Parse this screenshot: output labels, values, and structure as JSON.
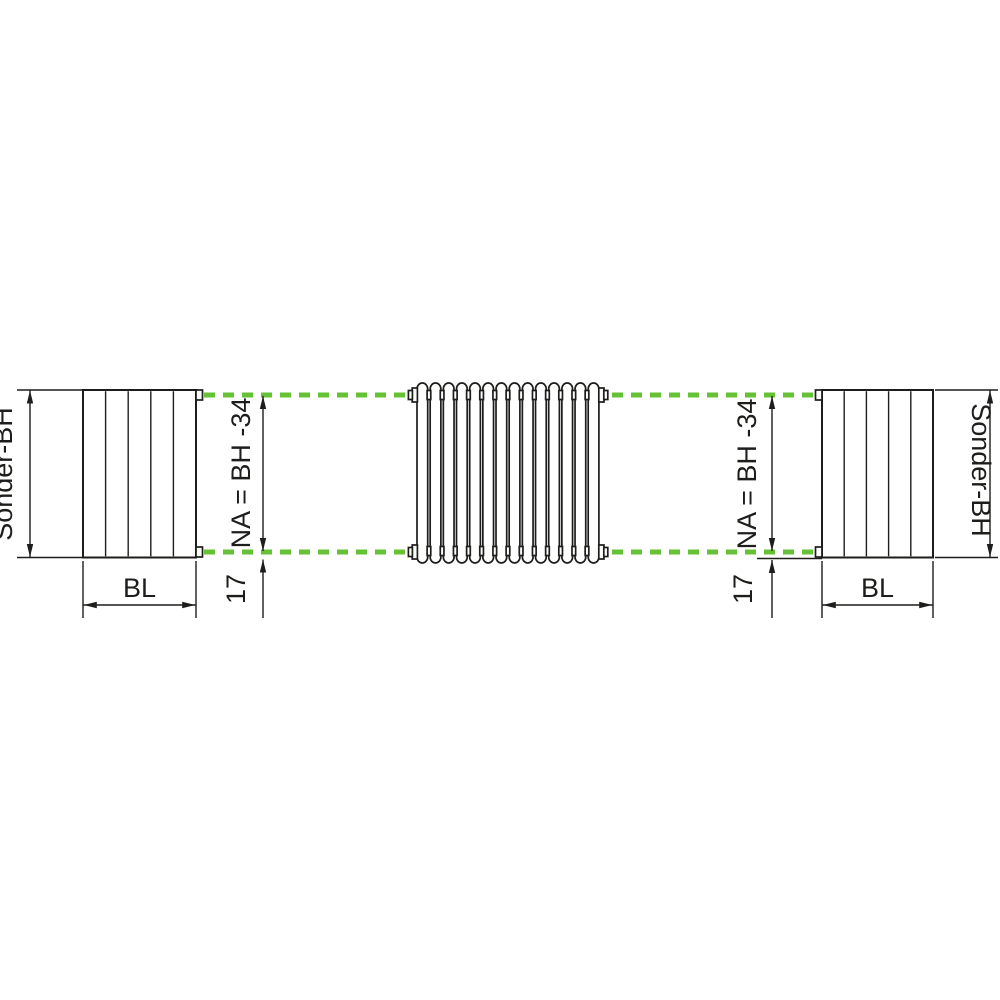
{
  "title": "Radiator nipple connection dimension drawing",
  "colors": {
    "accent_green": "#65c235",
    "line": "#1d1d1b"
  },
  "radiator": {
    "tube_count": 14
  },
  "side_panels": {
    "section_count": 5
  },
  "labels": {
    "height_left": "Sonder-BH",
    "height_right": "Sonder-BH",
    "width_left": "BL",
    "width_right": "BL",
    "nipple_distance_left": "NA = BH -34",
    "nipple_distance_right": "NA = BH -34",
    "offset_left": "17",
    "offset_right": "17"
  }
}
